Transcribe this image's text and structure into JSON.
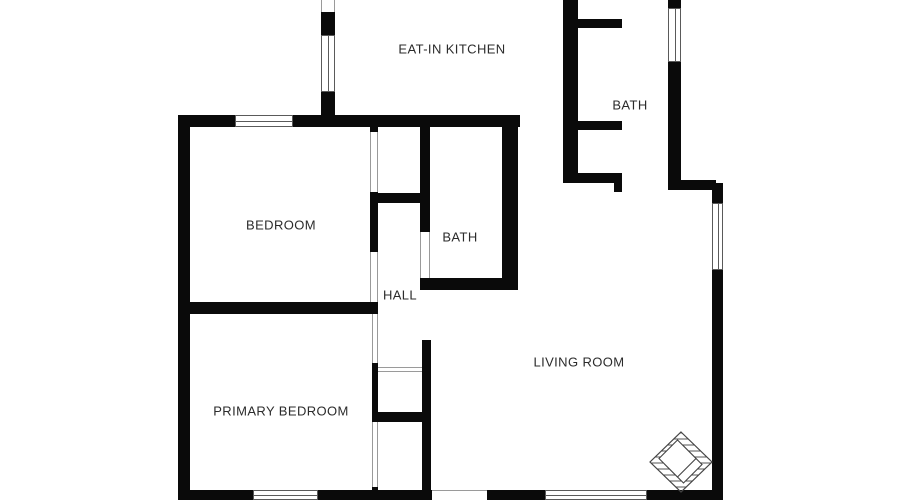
{
  "plan": {
    "type": "floor-plan",
    "rooms": [
      {
        "id": "eat-in-kitchen",
        "label": "EAT-IN KITCHEN",
        "x": 452,
        "y": 49,
        "size": 13
      },
      {
        "id": "bath-upper",
        "label": "BATH",
        "x": 630,
        "y": 105,
        "size": 13
      },
      {
        "id": "bedroom",
        "label": "BEDROOM",
        "x": 281,
        "y": 225,
        "size": 13
      },
      {
        "id": "bath-middle",
        "label": "BATH",
        "x": 460,
        "y": 237,
        "size": 13
      },
      {
        "id": "hall",
        "label": "HALL",
        "x": 400,
        "y": 295,
        "size": 13
      },
      {
        "id": "living-room",
        "label": "LIVING ROOM",
        "x": 579,
        "y": 362,
        "size": 13
      },
      {
        "id": "primary-bedroom",
        "label": "PRIMARY BEDROOM",
        "x": 281,
        "y": 411,
        "size": 13
      }
    ],
    "icons": [
      {
        "id": "compass-icon",
        "meaning": "hatched diamond compass / brand mark",
        "x": 681,
        "y": 462
      }
    ],
    "colors": {
      "wall": "#0a0a0a",
      "opening_line": "#9a9a9a",
      "window_border": "#5a5a5a",
      "text": "#2b2b2b",
      "background": "#ffffff"
    }
  }
}
